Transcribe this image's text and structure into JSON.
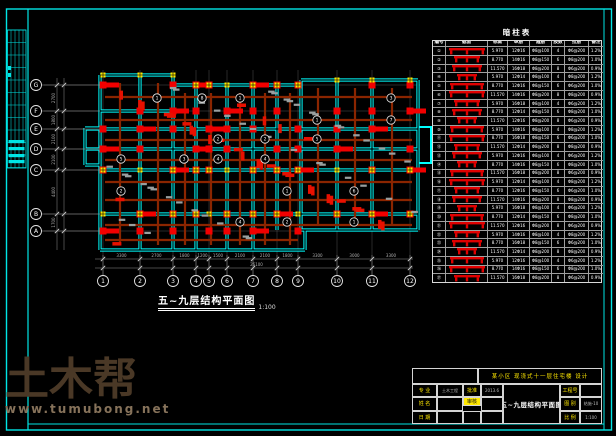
{
  "sheet": {
    "plan_title": "五~九层结构平面图",
    "plan_scale": "1:100"
  },
  "grid": {
    "cols": [
      "1",
      "2",
      "3",
      "4",
      "5",
      "6",
      "7",
      "8",
      "9",
      "10",
      "11",
      "12"
    ],
    "rows": [
      "G",
      "F",
      "E",
      "D",
      "C",
      "B",
      "A"
    ]
  },
  "dims": {
    "bottom": [
      "3300",
      "2700",
      "1800",
      "1200",
      "1500",
      "2100",
      "2100",
      "1800",
      "3300",
      "3000",
      "3300"
    ],
    "bottom_total": "26100",
    "left": [
      "2700",
      "1800",
      "2100",
      "2100",
      "4400",
      "1700"
    ]
  },
  "tags": [
    "1",
    "2",
    "1",
    "3",
    "2",
    "4",
    "1",
    "5",
    "3",
    "2",
    "6",
    "1",
    "4",
    "2",
    "7",
    "3",
    "1",
    "5",
    "2",
    "8",
    "4",
    "1"
  ],
  "schedule": {
    "title": "暗柱表",
    "headers": [
      "编号",
      "截面",
      "标高",
      "纵筋",
      "箍筋",
      "肢数",
      "拉筋",
      "备注"
    ],
    "rows": [
      {
        "no": "①",
        "elev": "5.970",
        "bars": "12Φ16",
        "stirrup": "Φ8@100",
        "legs": "4",
        "tie": "Φ6@200",
        "note": "1.2%"
      },
      {
        "no": "②",
        "elev": "8.770",
        "bars": "14Φ16",
        "stirrup": "Φ8@150",
        "legs": "6",
        "tie": "Φ8@200",
        "note": "1.0%"
      },
      {
        "no": "③",
        "elev": "11.570",
        "bars": "16Φ18",
        "stirrup": "Φ8@200",
        "legs": "8",
        "tie": "Φ6@200",
        "note": "0.9%"
      },
      {
        "no": "④",
        "elev": "5.970",
        "bars": "12Φ14",
        "stirrup": "Φ8@100",
        "legs": "4",
        "tie": "Φ8@200",
        "note": "1.2%"
      },
      {
        "no": "⑤",
        "elev": "8.770",
        "bars": "12Φ16",
        "stirrup": "Φ8@150",
        "legs": "6",
        "tie": "Φ6@200",
        "note": "1.0%"
      },
      {
        "no": "⑥",
        "elev": "11.570",
        "bars": "14Φ16",
        "stirrup": "Φ8@200",
        "legs": "8",
        "tie": "Φ8@200",
        "note": "0.9%"
      },
      {
        "no": "⑦",
        "elev": "5.970",
        "bars": "16Φ18",
        "stirrup": "Φ8@100",
        "legs": "4",
        "tie": "Φ6@200",
        "note": "1.2%"
      },
      {
        "no": "⑧",
        "elev": "8.770",
        "bars": "12Φ14",
        "stirrup": "Φ8@150",
        "legs": "6",
        "tie": "Φ8@200",
        "note": "1.0%"
      },
      {
        "no": "⑨",
        "elev": "11.570",
        "bars": "12Φ16",
        "stirrup": "Φ8@200",
        "legs": "8",
        "tie": "Φ6@200",
        "note": "0.9%"
      },
      {
        "no": "⑩",
        "elev": "5.970",
        "bars": "14Φ16",
        "stirrup": "Φ8@100",
        "legs": "4",
        "tie": "Φ8@200",
        "note": "1.2%"
      },
      {
        "no": "⑪",
        "elev": "8.770",
        "bars": "16Φ18",
        "stirrup": "Φ8@150",
        "legs": "6",
        "tie": "Φ6@200",
        "note": "1.0%"
      },
      {
        "no": "⑫",
        "elev": "11.570",
        "bars": "12Φ14",
        "stirrup": "Φ8@200",
        "legs": "8",
        "tie": "Φ8@200",
        "note": "0.9%"
      },
      {
        "no": "⑬",
        "elev": "5.970",
        "bars": "12Φ16",
        "stirrup": "Φ8@100",
        "legs": "4",
        "tie": "Φ6@200",
        "note": "1.2%"
      },
      {
        "no": "⑭",
        "elev": "8.770",
        "bars": "14Φ16",
        "stirrup": "Φ8@150",
        "legs": "6",
        "tie": "Φ8@200",
        "note": "1.0%"
      },
      {
        "no": "⑮",
        "elev": "11.570",
        "bars": "16Φ18",
        "stirrup": "Φ8@200",
        "legs": "8",
        "tie": "Φ6@200",
        "note": "0.9%"
      },
      {
        "no": "⑯",
        "elev": "5.970",
        "bars": "12Φ14",
        "stirrup": "Φ8@100",
        "legs": "4",
        "tie": "Φ8@200",
        "note": "1.2%"
      },
      {
        "no": "⑰",
        "elev": "8.770",
        "bars": "12Φ16",
        "stirrup": "Φ8@150",
        "legs": "6",
        "tie": "Φ6@200",
        "note": "1.0%"
      },
      {
        "no": "⑱",
        "elev": "11.570",
        "bars": "14Φ16",
        "stirrup": "Φ8@200",
        "legs": "8",
        "tie": "Φ8@200",
        "note": "0.9%"
      },
      {
        "no": "⑲",
        "elev": "5.970",
        "bars": "16Φ18",
        "stirrup": "Φ8@100",
        "legs": "4",
        "tie": "Φ6@200",
        "note": "1.2%"
      },
      {
        "no": "⑳",
        "elev": "8.770",
        "bars": "12Φ14",
        "stirrup": "Φ8@150",
        "legs": "6",
        "tie": "Φ8@200",
        "note": "1.0%"
      },
      {
        "no": "㉑",
        "elev": "11.570",
        "bars": "12Φ16",
        "stirrup": "Φ8@200",
        "legs": "8",
        "tie": "Φ6@200",
        "note": "0.9%"
      },
      {
        "no": "㉒",
        "elev": "5.970",
        "bars": "14Φ16",
        "stirrup": "Φ8@100",
        "legs": "4",
        "tie": "Φ8@200",
        "note": "1.2%"
      },
      {
        "no": "㉓",
        "elev": "8.770",
        "bars": "16Φ18",
        "stirrup": "Φ8@150",
        "legs": "6",
        "tie": "Φ6@200",
        "note": "1.0%"
      },
      {
        "no": "㉔",
        "elev": "11.570",
        "bars": "12Φ14",
        "stirrup": "Φ8@200",
        "legs": "8",
        "tie": "Φ8@200",
        "note": "0.9%"
      },
      {
        "no": "㉕",
        "elev": "5.970",
        "bars": "12Φ16",
        "stirrup": "Φ8@100",
        "legs": "4",
        "tie": "Φ6@200",
        "note": "1.2%"
      },
      {
        "no": "㉖",
        "elev": "8.770",
        "bars": "14Φ16",
        "stirrup": "Φ8@150",
        "legs": "6",
        "tie": "Φ8@200",
        "note": "1.0%"
      },
      {
        "no": "㉗",
        "elev": "11.570",
        "bars": "16Φ18",
        "stirrup": "Φ8@200",
        "legs": "8",
        "tie": "Φ6@200",
        "note": "0.9%"
      }
    ]
  },
  "title_block": {
    "project": "某小区 现浇式十一层住宅楼 设计",
    "drawing_name": "五~九层结构平面图",
    "fields_left": [
      {
        "l": "专 业",
        "v": "土木工程",
        "l2": "批准",
        "v2": "2013.6",
        "hl": false
      },
      {
        "l": "姓 名",
        "v": "",
        "l2": "审核",
        "v2": "",
        "hl": true
      },
      {
        "l": "日 期",
        "v": "",
        "l2": "",
        "v2": "",
        "hl": false
      }
    ],
    "fields_right": [
      {
        "l": "工程号",
        "v": ""
      },
      {
        "l": "图 别",
        "v": "结施-10"
      },
      {
        "l": "比 例",
        "v": "1:100"
      }
    ]
  },
  "watermark": {
    "brand": "土木帮",
    "url": "www.tumubong.net"
  },
  "colors": {
    "wall": "#00ffff",
    "column": "#f20000",
    "beam": "#8b2500",
    "marker": "#ffe800",
    "frame": "#00e5e5",
    "dimtext": "#b0b0b0",
    "accent_yellow": "#ffe800"
  }
}
